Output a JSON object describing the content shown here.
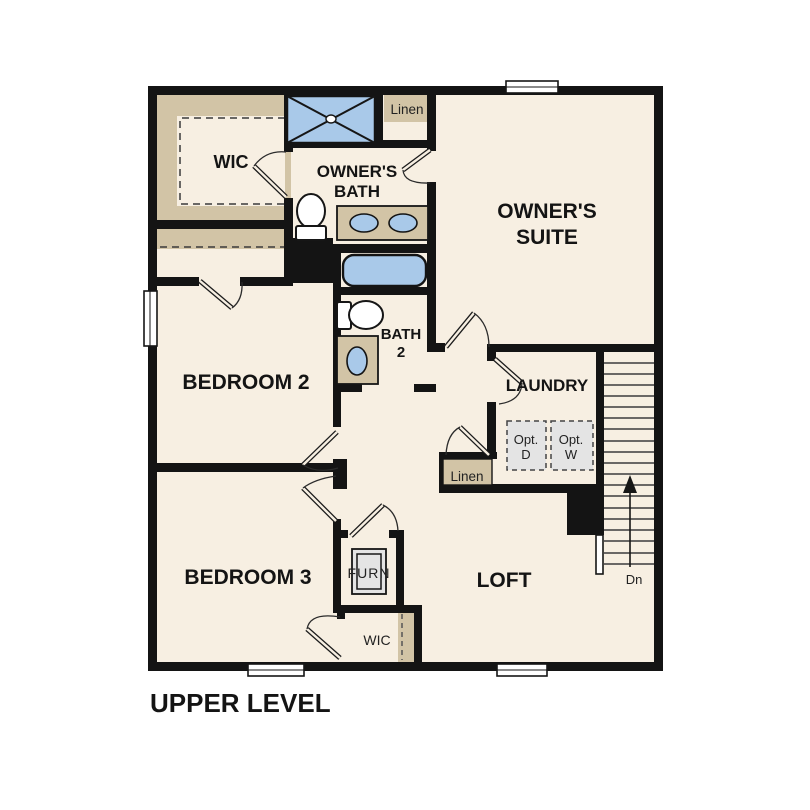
{
  "plan": {
    "level_title": "UPPER LEVEL",
    "colors": {
      "floor": "#f7efe2",
      "wall": "#141414",
      "closet_tan": "#d2c4a6",
      "fixture_blue": "#a9c9e9",
      "appliance_gray": "#e4e4e4"
    },
    "rooms": {
      "wic_upper": {
        "label": "WIC"
      },
      "owners_bath": {
        "line1": "OWNER'S",
        "line2": "BATH"
      },
      "owners_suite": {
        "line1": "OWNER'S",
        "line2": "SUITE"
      },
      "bedroom2": {
        "label": "BEDROOM 2"
      },
      "bath2": {
        "line1": "BATH",
        "line2": "2"
      },
      "laundry": {
        "label": "LAUNDRY"
      },
      "bedroom3": {
        "label": "BEDROOM 3"
      },
      "loft": {
        "label": "LOFT"
      },
      "wic_lower": {
        "label": "WIC"
      }
    },
    "closets": {
      "linen_upper": {
        "label": "Linen"
      },
      "linen_lower": {
        "label": "Linen"
      },
      "furnace": {
        "label": "FURN"
      }
    },
    "laundry_appliances": {
      "optional_dryer": {
        "line1": "Opt.",
        "line2": "D"
      },
      "optional_washer": {
        "line1": "Opt.",
        "line2": "W"
      }
    },
    "stairs": {
      "direction_label": "Dn"
    }
  }
}
